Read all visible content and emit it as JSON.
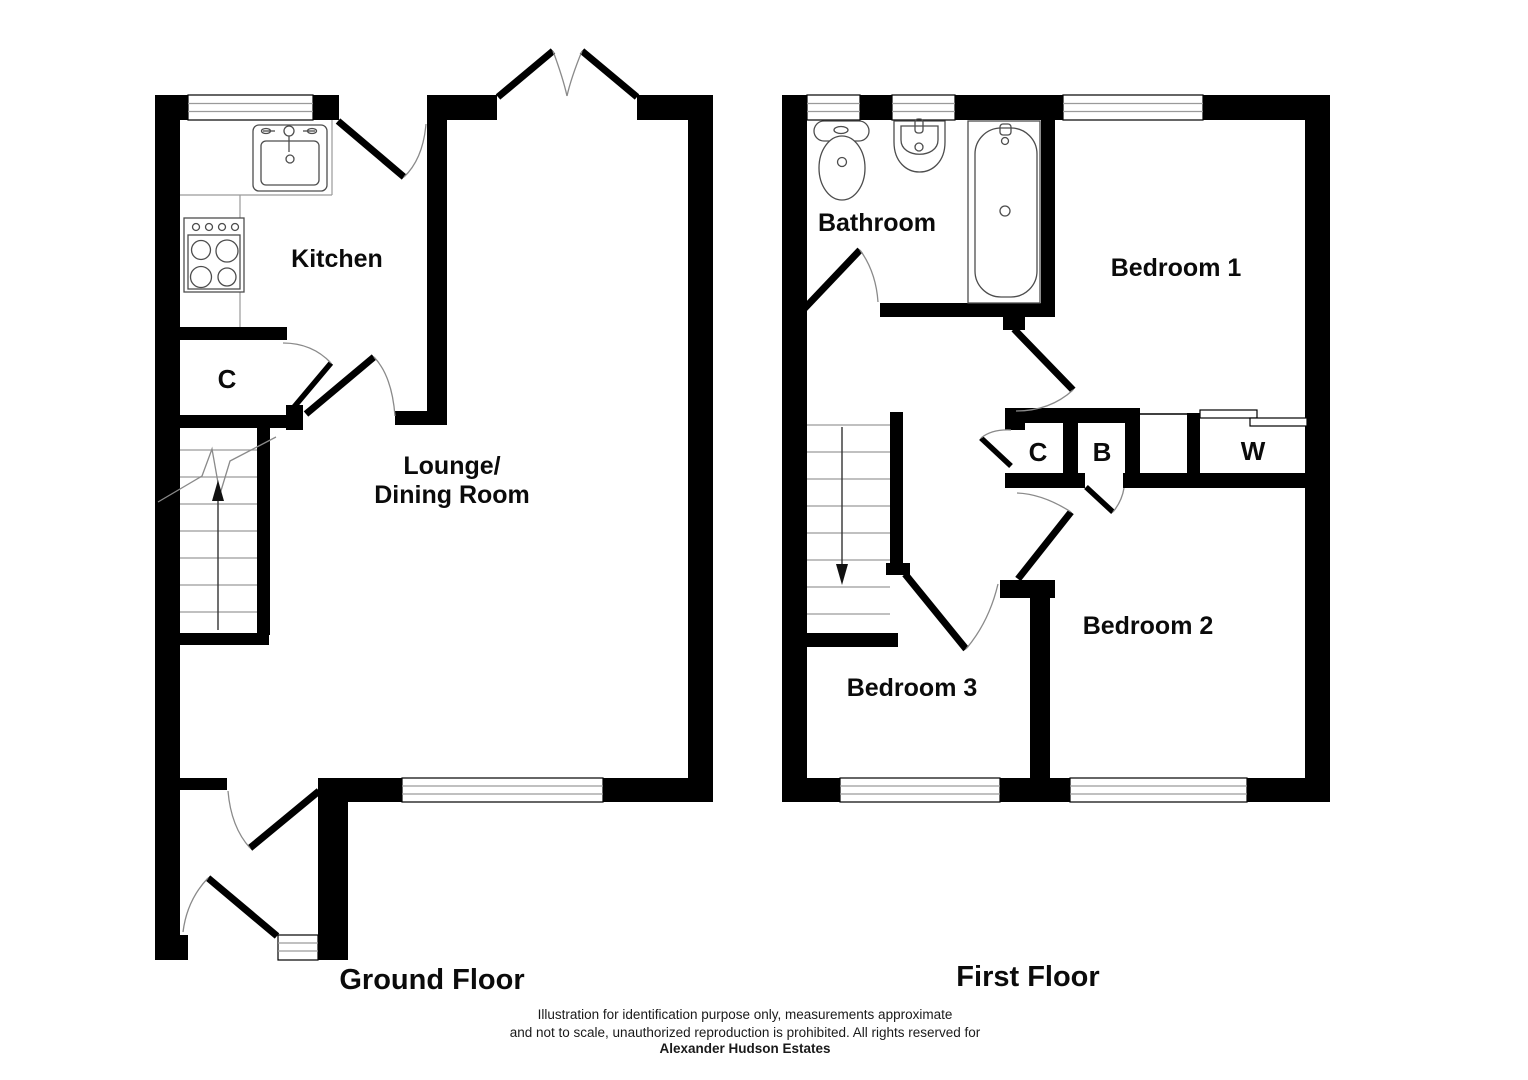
{
  "ground_floor": {
    "caption": "Ground Floor",
    "labels": {
      "kitchen": "Kitchen",
      "cupboard": "C",
      "lounge_line1": "Lounge/",
      "lounge_line2": "Dining Room"
    }
  },
  "first_floor": {
    "caption": "First Floor",
    "labels": {
      "bathroom": "Bathroom",
      "bedroom1": "Bedroom 1",
      "bedroom2": "Bedroom 2",
      "bedroom3": "Bedroom 3",
      "cupboard": "C",
      "boiler": "B",
      "wardrobe": "W"
    }
  },
  "disclaimer": {
    "line1": "Illustration for identification purpose only, measurements approximate",
    "line2": "and not to scale, unauthorized reproduction is prohibited. All rights reserved for",
    "line3": "Alexander Hudson Estates"
  },
  "colors": {
    "wall": "#000000",
    "background": "#ffffff"
  }
}
